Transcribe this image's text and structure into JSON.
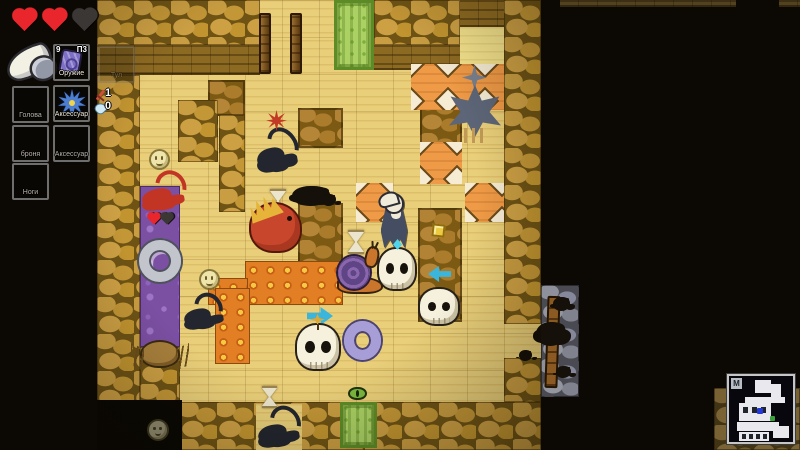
{
  "sidebar": {
    "hearts": {
      "filled": 2,
      "empty": 1
    },
    "held_item": "white-horn-club",
    "weapon_slot": {
      "label": "Оружие",
      "count": "9",
      "ammo": "П3",
      "item": "purple-card"
    },
    "partial_slot": {
      "label": "Тул"
    },
    "head_slot": {
      "label": "Голова"
    },
    "accessory_slot_1": {
      "label": "Аксессуар",
      "item": "blue-spike-charm"
    },
    "armor_slot": {
      "label": "броня"
    },
    "accessory_slot_2": {
      "label": "Аксессуар"
    },
    "legs_slot": {
      "label": "Ноги"
    },
    "counters": {
      "swords": "1",
      "water": "0"
    }
  },
  "colors": {
    "sand": "#e9cf7a",
    "wall": "#c89c40",
    "fire": "#e8862a",
    "poison": "#7b4fa2",
    "trap": "#ef9a46",
    "green": "#abd164",
    "heart": "#e8262c",
    "minimap_player": "#2438d8",
    "minimap_exit": "#3aa03c"
  },
  "map": {
    "tiles": [
      {
        "t": "sand",
        "x": 97,
        "y": 0,
        "w": 444,
        "h": 450
      },
      {
        "t": "grid",
        "x": 97,
        "y": 0,
        "w": 444,
        "h": 450
      },
      {
        "t": "walltop",
        "x": 97,
        "y": 0,
        "w": 163,
        "h": 45
      },
      {
        "t": "wallface",
        "x": 97,
        "y": 45,
        "w": 163,
        "h": 30
      },
      {
        "t": "walltop",
        "x": 374,
        "y": 0,
        "w": 86,
        "h": 45
      },
      {
        "t": "wallface",
        "x": 374,
        "y": 45,
        "w": 86,
        "h": 25
      },
      {
        "t": "wallface",
        "x": 460,
        "y": 0,
        "w": 44,
        "h": 27
      },
      {
        "t": "sandlight",
        "x": 460,
        "y": 27,
        "w": 44,
        "h": 40
      },
      {
        "t": "walltop",
        "x": 504,
        "y": 0,
        "w": 37,
        "h": 324
      },
      {
        "t": "walltop",
        "x": 504,
        "y": 358,
        "w": 37,
        "h": 44
      },
      {
        "t": "walltop",
        "x": 97,
        "y": 75,
        "w": 43,
        "h": 332
      },
      {
        "t": "dirt",
        "x": 208,
        "y": 80,
        "w": 37,
        "h": 36
      },
      {
        "t": "walltop",
        "x": 178,
        "y": 100,
        "w": 40,
        "h": 62
      },
      {
        "t": "walltop",
        "x": 219,
        "y": 115,
        "w": 26,
        "h": 97
      },
      {
        "t": "walltop",
        "x": 140,
        "y": 347,
        "w": 40,
        "h": 57
      },
      {
        "t": "poison",
        "x": 140,
        "y": 186,
        "w": 40,
        "h": 161
      },
      {
        "t": "dirt",
        "x": 298,
        "y": 108,
        "w": 45,
        "h": 40
      },
      {
        "t": "dirt",
        "x": 298,
        "y": 203,
        "w": 45,
        "h": 72
      },
      {
        "t": "dirt",
        "x": 420,
        "y": 96,
        "w": 42,
        "h": 50
      },
      {
        "t": "dirt",
        "x": 418,
        "y": 208,
        "w": 44,
        "h": 114
      },
      {
        "t": "trap",
        "x": 411,
        "y": 64,
        "w": 93,
        "h": 46
      },
      {
        "t": "trap",
        "x": 420,
        "y": 142,
        "w": 42,
        "h": 42
      },
      {
        "t": "trap",
        "x": 356,
        "y": 183,
        "w": 37,
        "h": 39
      },
      {
        "t": "trap",
        "x": 465,
        "y": 183,
        "w": 39,
        "h": 39
      },
      {
        "t": "fire",
        "x": 245,
        "y": 261,
        "w": 98,
        "h": 44
      },
      {
        "t": "fire",
        "x": 208,
        "y": 278,
        "w": 40,
        "h": 27
      },
      {
        "t": "fire",
        "x": 215,
        "y": 288,
        "w": 35,
        "h": 76
      },
      {
        "t": "green",
        "x": 334,
        "y": 0,
        "w": 40,
        "h": 70
      },
      {
        "t": "walltop",
        "x": 180,
        "y": 402,
        "w": 361,
        "h": 48
      },
      {
        "t": "sand",
        "x": 256,
        "y": 404,
        "w": 46,
        "h": 46
      },
      {
        "t": "green",
        "x": 340,
        "y": 402,
        "w": 37,
        "h": 46
      },
      {
        "t": "gray",
        "x": 541,
        "y": 285,
        "w": 38,
        "h": 112
      },
      {
        "t": "dark",
        "x": 97,
        "y": 400,
        "w": 85,
        "h": 50
      },
      {
        "t": "walltop",
        "v": "dim",
        "x": 714,
        "y": 388,
        "w": 86,
        "h": 62
      },
      {
        "t": "wallface",
        "v": "dim",
        "x": 560,
        "y": 0,
        "w": 176,
        "h": 7
      },
      {
        "t": "wallface",
        "v": "dim",
        "x": 779,
        "y": 0,
        "w": 21,
        "h": 7
      }
    ],
    "entities": [
      {
        "t": "door",
        "n": "door",
        "x": 259,
        "y": 13,
        "w": 12,
        "h": 61
      },
      {
        "t": "door",
        "n": "door",
        "x": 290,
        "y": 13,
        "w": 12,
        "h": 61
      },
      {
        "t": "smiley",
        "n": "sand-dollar-creature",
        "x": 151,
        "y": 151,
        "w": 17,
        "h": 17
      },
      {
        "t": "scorpion",
        "v": "red",
        "n": "red-scorpion-enemy",
        "x": 141,
        "y": 170,
        "w": 47,
        "h": 42
      },
      {
        "t": "heart",
        "n": "enemy-health-heart",
        "x": 150,
        "y": 215,
        "w": 8,
        "h": 8,
        "i": false
      },
      {
        "t": "heart",
        "v": "empty",
        "n": "enemy-health-heart-empty",
        "x": 163,
        "y": 215,
        "w": 8,
        "h": 8,
        "i": false
      },
      {
        "t": "ring",
        "n": "gray-ring-item",
        "x": 139,
        "y": 240,
        "w": 42,
        "h": 42
      },
      {
        "t": "smiley",
        "n": "sand-dollar-creature",
        "x": 201,
        "y": 271,
        "w": 17,
        "h": 17
      },
      {
        "t": "scorpion",
        "n": "black-scorpion",
        "x": 183,
        "y": 292,
        "w": 42,
        "h": 38
      },
      {
        "t": "spider",
        "n": "spider",
        "x": 142,
        "y": 342,
        "w": 36,
        "h": 24
      },
      {
        "t": "scorpion",
        "n": "black-scorpion",
        "x": 256,
        "y": 126,
        "w": 44,
        "h": 48
      },
      {
        "t": "burst",
        "n": "damage-burst",
        "x": 266,
        "y": 110,
        "w": 21,
        "h": 21,
        "i": false
      },
      {
        "t": "hourglass",
        "n": "hourglass-item",
        "x": 270,
        "y": 189,
        "w": 16,
        "h": 24
      },
      {
        "t": "lizard",
        "n": "red-lizard-creature",
        "x": 251,
        "y": 204,
        "w": 49,
        "h": 47
      },
      {
        "t": "ink",
        "n": "ink-splotch",
        "x": 292,
        "y": 186,
        "w": 38,
        "h": 20,
        "i": false
      },
      {
        "t": "ink",
        "n": "ink-splotch",
        "x": 322,
        "y": 194,
        "w": 14,
        "h": 12,
        "i": false
      },
      {
        "t": "hourglass",
        "n": "hourglass-item",
        "x": 348,
        "y": 230,
        "w": 16,
        "h": 24
      },
      {
        "t": "snail",
        "n": "snail",
        "x": 337,
        "y": 256,
        "w": 46,
        "h": 36
      },
      {
        "t": "snailhead",
        "n": "snail-head",
        "x": 365,
        "y": 246,
        "w": 14,
        "h": 22,
        "i": false
      },
      {
        "t": "skull",
        "n": "skull",
        "x": 379,
        "y": 249,
        "w": 36,
        "h": 40
      },
      {
        "t": "reaper",
        "n": "player-character",
        "x": 377,
        "y": 195,
        "w": 36,
        "h": 54
      },
      {
        "t": "horncurl",
        "n": "player-hat-feather",
        "x": 378,
        "y": 192,
        "w": 21,
        "h": 15,
        "i": false
      },
      {
        "t": "sparkle",
        "n": "cyan-sparkle",
        "x": 393,
        "y": 239,
        "w": 9,
        "h": 11,
        "i": false
      },
      {
        "t": "gold",
        "n": "gold-item",
        "x": 432,
        "y": 224,
        "w": 13,
        "h": 13
      },
      {
        "t": "arrow",
        "v": "left",
        "n": "left-arrow-marker",
        "x": 428,
        "y": 266,
        "w": 23,
        "h": 16
      },
      {
        "t": "skull",
        "n": "skull",
        "x": 420,
        "y": 289,
        "w": 38,
        "h": 35
      },
      {
        "t": "arrow",
        "n": "right-arrow-marker",
        "x": 307,
        "y": 307,
        "w": 26,
        "h": 18
      },
      {
        "t": "skull",
        "n": "skull",
        "x": 297,
        "y": 325,
        "w": 42,
        "h": 44
      },
      {
        "t": "twig",
        "n": "star-twig",
        "x": 310,
        "y": 314,
        "w": 15,
        "h": 16,
        "i": false
      },
      {
        "t": "ring",
        "v": "purple",
        "n": "purple-ring-item",
        "x": 344,
        "y": 321,
        "w": 37,
        "h": 39
      },
      {
        "t": "shuriken",
        "n": "shuriken-creature",
        "x": 462,
        "y": 65,
        "w": 25,
        "h": 25
      },
      {
        "t": "starbeast",
        "n": "spike-star-creature",
        "x": 449,
        "y": 85,
        "w": 52,
        "h": 52
      },
      {
        "t": "hourglass",
        "n": "hourglass-item",
        "x": 262,
        "y": 386,
        "w": 15,
        "h": 22
      },
      {
        "t": "eye",
        "n": "eye-item",
        "x": 348,
        "y": 387,
        "w": 19,
        "h": 13
      },
      {
        "t": "scorpion",
        "n": "black-scorpion",
        "x": 257,
        "y": 405,
        "w": 45,
        "h": 43
      },
      {
        "t": "smiley",
        "v": "dim",
        "n": "sand-dollar-creature",
        "x": 149,
        "y": 421,
        "w": 18,
        "h": 18
      },
      {
        "t": "post",
        "n": "wooden-post",
        "x": 546,
        "y": 296,
        "w": 13,
        "h": 92,
        "i": false
      },
      {
        "t": "ink",
        "n": "ink-splotch",
        "x": 536,
        "y": 322,
        "w": 30,
        "h": 24,
        "i": false
      },
      {
        "t": "ink",
        "n": "ink-splotch",
        "x": 553,
        "y": 297,
        "w": 17,
        "h": 14,
        "i": false
      },
      {
        "t": "ink",
        "n": "ink-splotch",
        "x": 519,
        "y": 350,
        "w": 13,
        "h": 11,
        "i": false
      },
      {
        "t": "ink",
        "n": "ink-splotch",
        "x": 556,
        "y": 366,
        "w": 15,
        "h": 12,
        "i": false
      }
    ]
  },
  "minimap": {
    "badge": "M",
    "rooms": [
      [
        26,
        4,
        16,
        13
      ],
      [
        42,
        8,
        10,
        16
      ],
      [
        16,
        21,
        40,
        6
      ],
      [
        10,
        27,
        32,
        18
      ],
      [
        8,
        46,
        42,
        9
      ],
      [
        10,
        56,
        30,
        9
      ],
      [
        44,
        50,
        16,
        12
      ]
    ],
    "pips": [
      [
        14,
        31,
        5,
        6
      ],
      [
        23,
        31,
        5,
        6
      ],
      [
        32,
        31,
        5,
        6
      ],
      [
        13,
        58,
        4,
        5
      ],
      [
        20,
        58,
        4,
        5
      ],
      [
        27,
        58,
        4,
        5
      ],
      [
        34,
        58,
        4,
        5
      ]
    ],
    "player_dot": [
      28,
      32,
      6,
      6
    ],
    "exit_dot": [
      41,
      40,
      5,
      5
    ]
  }
}
